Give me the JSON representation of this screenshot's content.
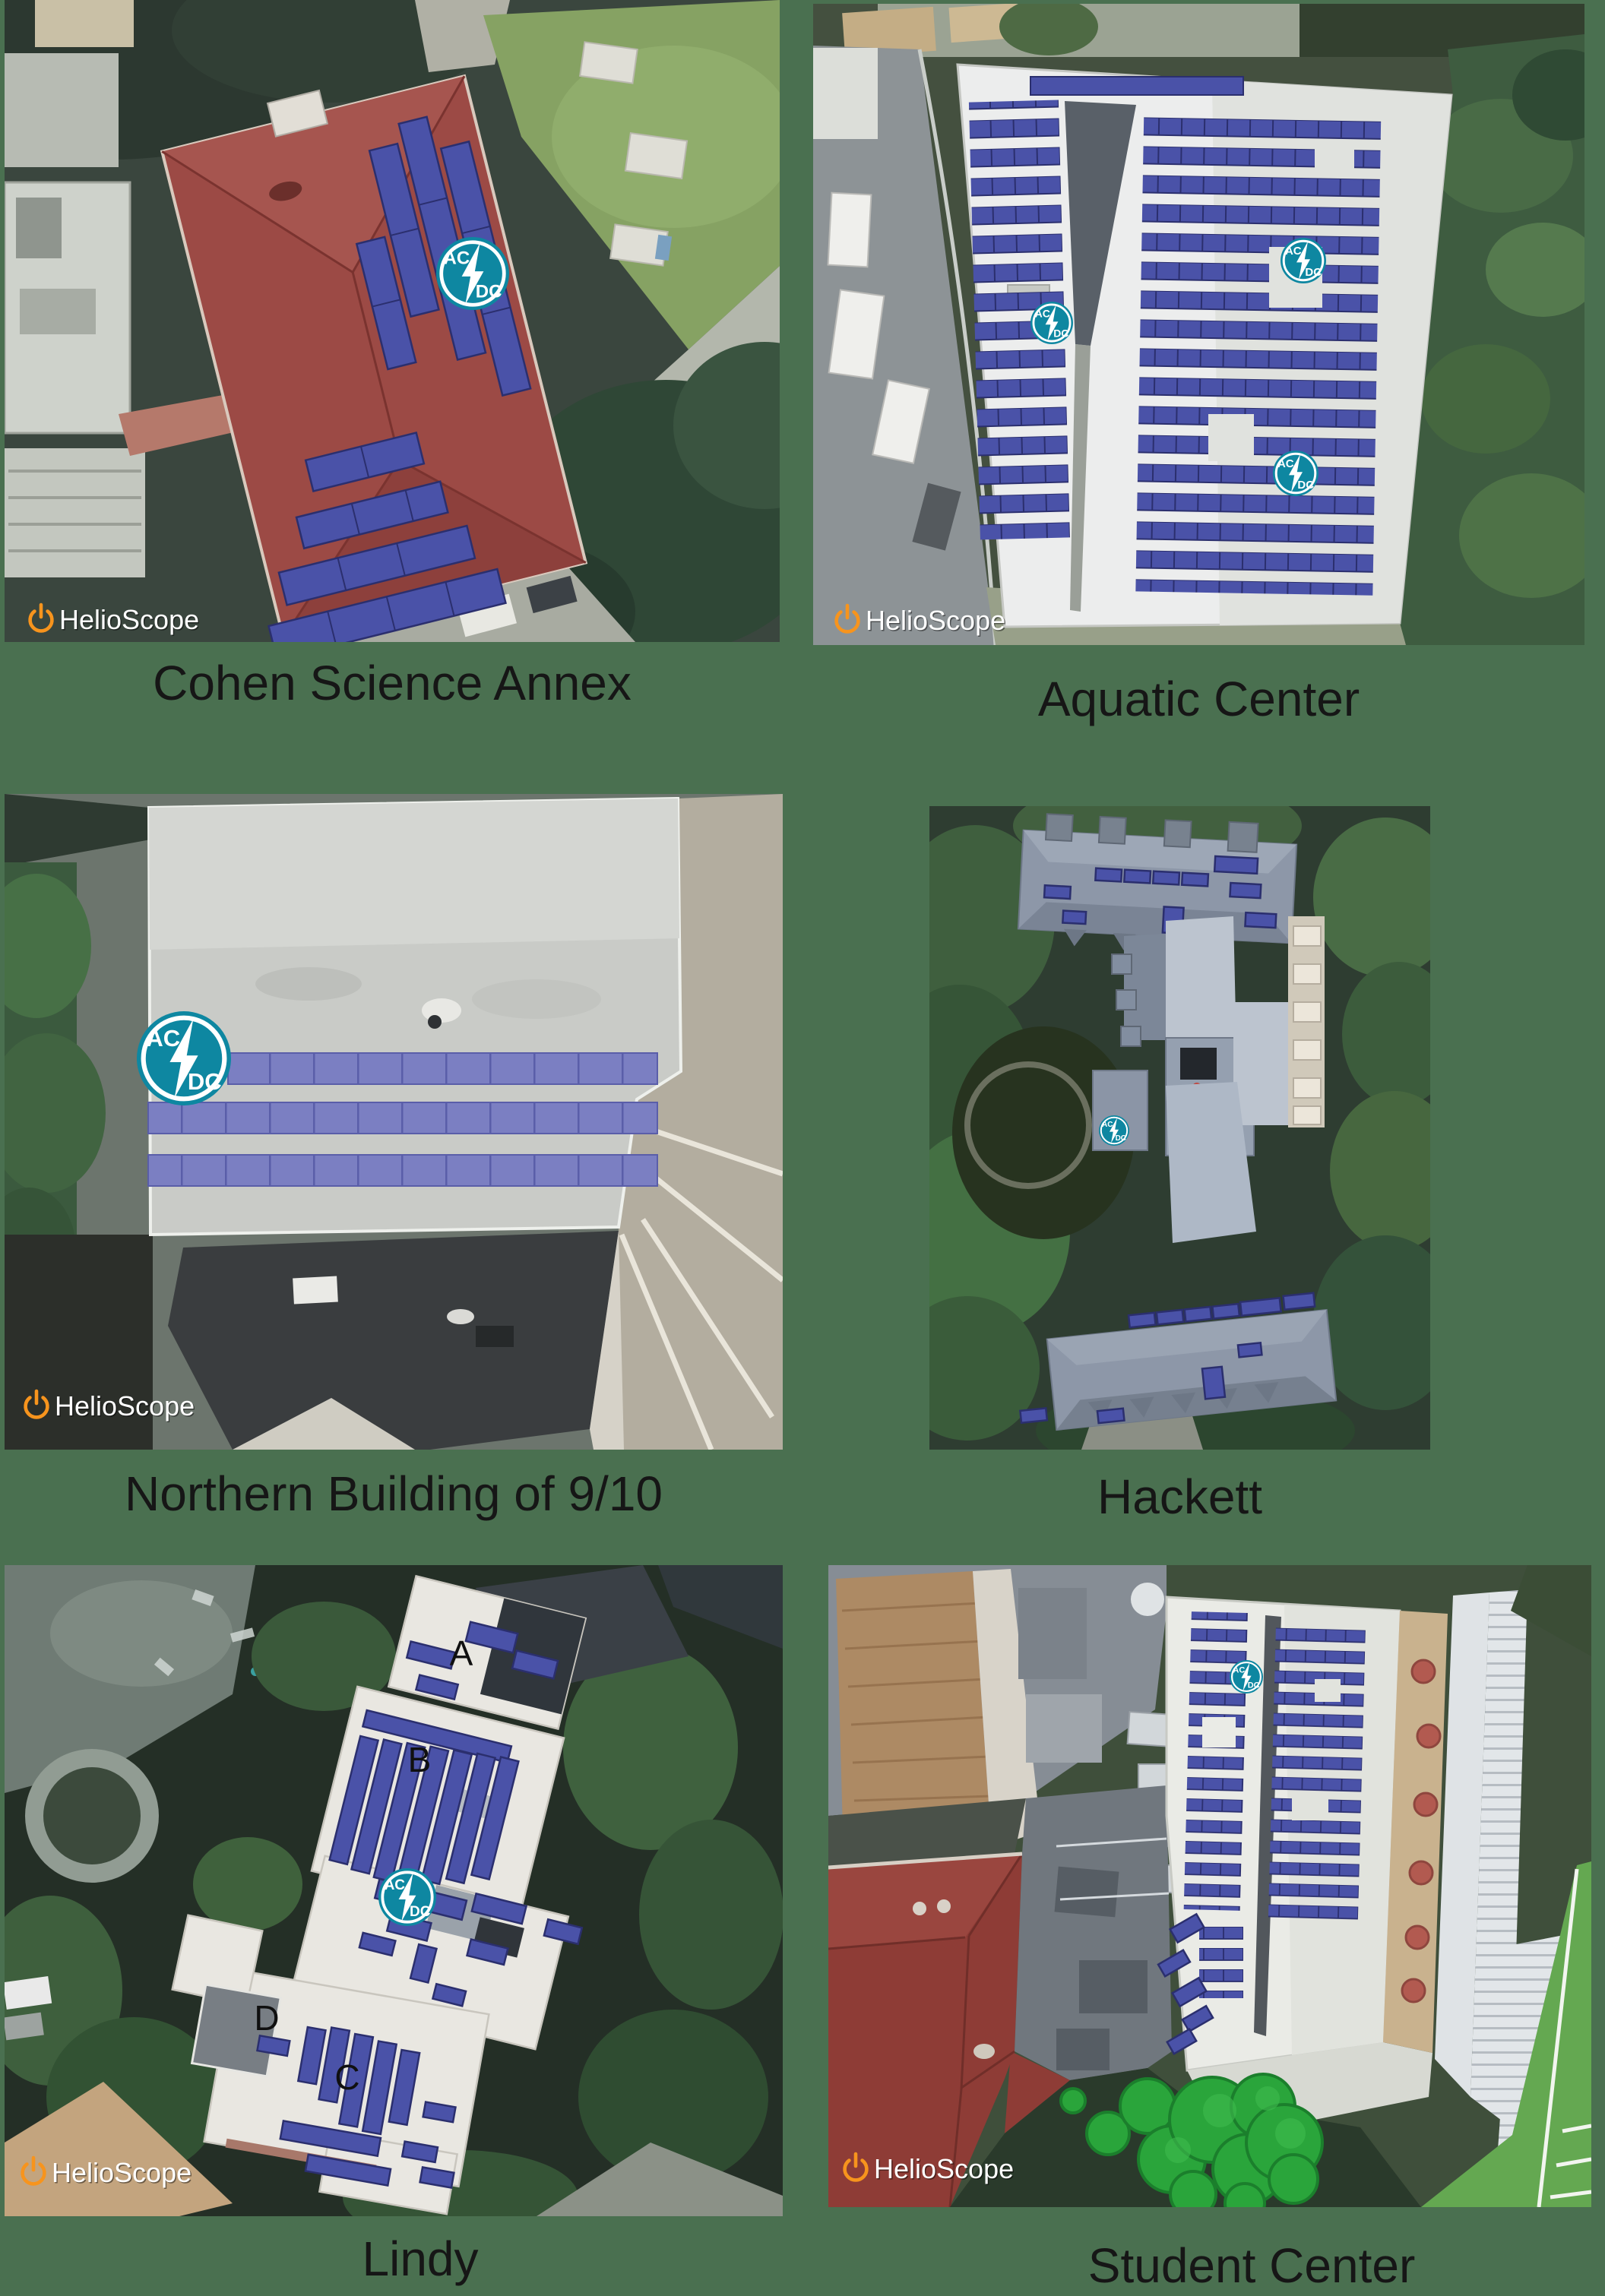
{
  "page": {
    "background_color": "#4a7050",
    "caption_color": "#161616",
    "description": "Six HelioScope aerial solar-design renders with captions"
  },
  "branding": {
    "watermark_text": "HelioScope",
    "watermark_icon": "power-icon",
    "watermark_icon_color": "#f7941d",
    "watermark_text_color": "#ffffff"
  },
  "inverter_badge": {
    "top_label": "AC",
    "bottom_label": "DC",
    "icon": "lightning-bolt-icon",
    "color": "#0e87a1"
  },
  "colors": {
    "solar_panel": "#4a52a8",
    "solar_panel_light": "#7b7fc2",
    "panel_outline": "#2b2f6e",
    "render_tree_green": "#2aa53b"
  },
  "tiles": [
    {
      "id": "cohen-science-annex",
      "caption": "Cohen Science Annex",
      "watermark": true,
      "acdc_badge_count": 1
    },
    {
      "id": "aquatic-center",
      "caption": "Aquatic Center",
      "watermark": true,
      "acdc_badge_count": 3
    },
    {
      "id": "northern-building",
      "caption": "Northern Building of 9/10",
      "watermark": true,
      "acdc_badge_count": 1
    },
    {
      "id": "hackett",
      "caption": "Hackett",
      "watermark": false,
      "acdc_badge_count": 1
    },
    {
      "id": "lindy",
      "caption": "Lindy",
      "watermark": true,
      "acdc_badge_count": 1,
      "roof_labels": [
        "A",
        "B",
        "C",
        "D"
      ]
    },
    {
      "id": "student-center",
      "caption": "Student Center",
      "watermark": true,
      "acdc_badge_count": 1
    }
  ]
}
